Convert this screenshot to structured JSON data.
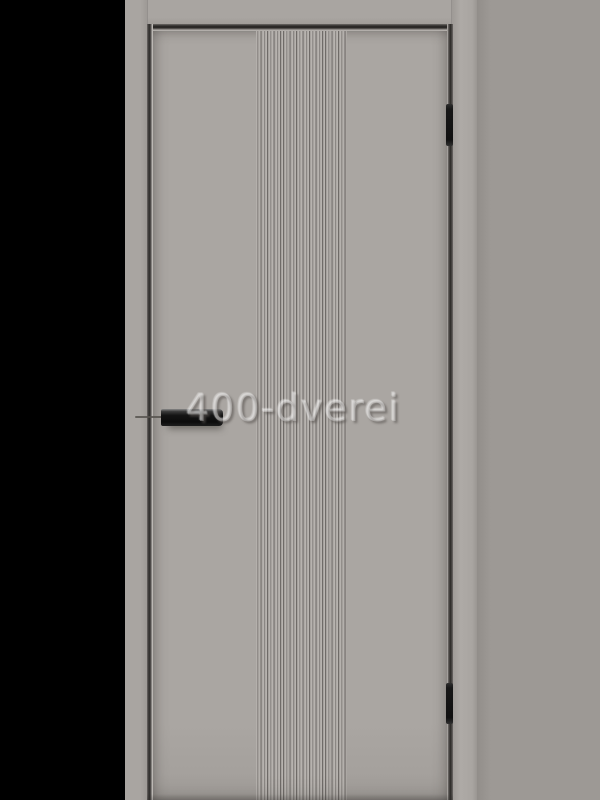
{
  "photo": {
    "subject": "interior-door-product-photo",
    "watermark_text": "400-dverei"
  },
  "door": {
    "finish_color_name": "grey",
    "decor": "vertical-fluted-center-strip",
    "hardware": {
      "handle": "black-horizontal-bar-handle",
      "hinges": [
        "top-hinge",
        "bottom-hinge"
      ],
      "hardware_color": "#131313"
    }
  },
  "colors": {
    "letterbox": "#000000",
    "backdrop": "#9d9995",
    "frame": "#a9a5a1",
    "frame-shade": "#9e9a96",
    "leaf": "#aaa6a2",
    "leaf-shade": "#a19d99",
    "flute-light": "#b7b3af",
    "flute-dark": "#6f6b68",
    "flute-mid": "#a6a29e",
    "gap-dark": "#2b2927",
    "gap-mid": "#6e6a67",
    "edge-highlight": "#c4c0bc",
    "hardware": "#131313",
    "wm-fill": "rgba(255,255,255,0.30)",
    "wm-shadow": "rgba(88,84,80,0.60)"
  }
}
